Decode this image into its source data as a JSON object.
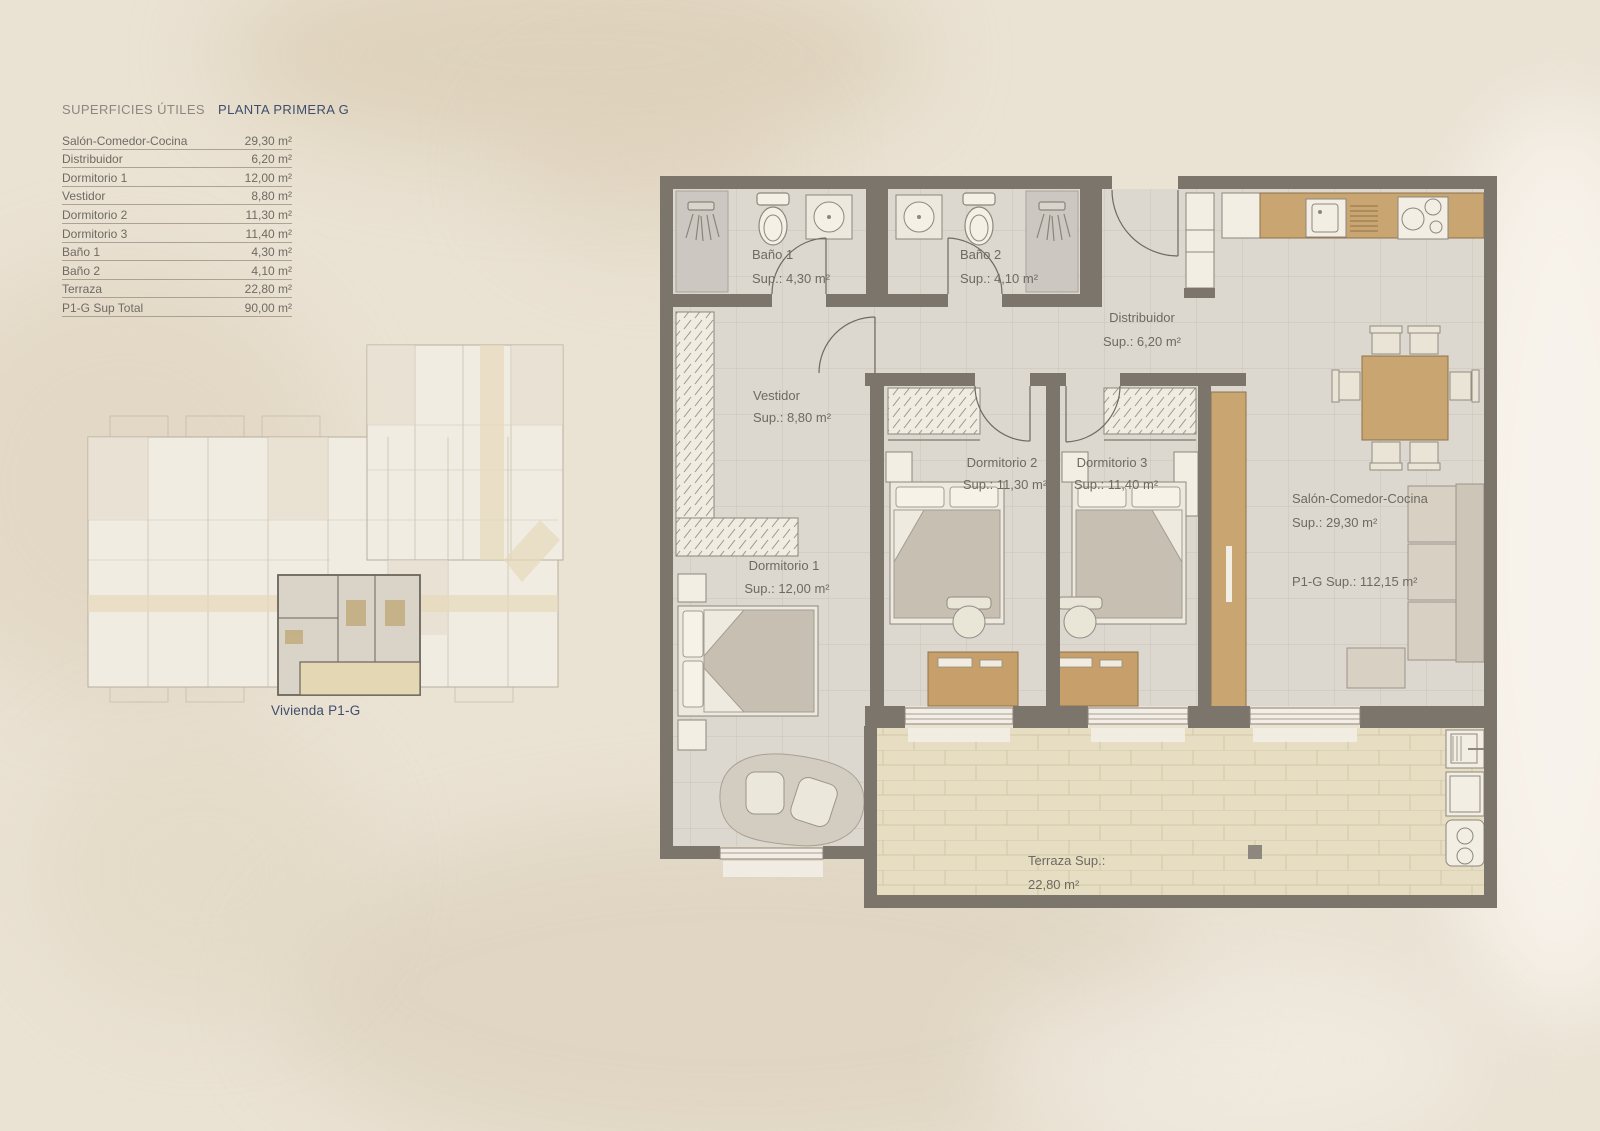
{
  "surface_table": {
    "title_left": "SUPERFICIES ÚTILES",
    "title_right": "PLANTA PRIMERA  G",
    "rows": [
      {
        "label": "Salón-Comedor-Cocina",
        "value": "29,30 m²"
      },
      {
        "label": "Distribuidor",
        "value": "6,20 m²"
      },
      {
        "label": "Dormitorio 1",
        "value": "12,00 m²"
      },
      {
        "label": "Vestidor",
        "value": "8,80 m²"
      },
      {
        "label": "Dormitorio 2",
        "value": "11,30 m²"
      },
      {
        "label": "Dormitorio 3",
        "value": "11,40 m²"
      },
      {
        "label": "Baño 1",
        "value": "4,30 m²"
      },
      {
        "label": "Baño 2",
        "value": "4,10 m²"
      },
      {
        "label": "Terraza",
        "value": "22,80 m²"
      },
      {
        "label": "P1-G Sup Total",
        "value": "90,00 m²"
      }
    ]
  },
  "overview": {
    "caption": "Vivienda P1-G"
  },
  "plan": {
    "rooms": {
      "bano1": {
        "name": "Baño 1",
        "sup": "Sup.: 4,30  m²"
      },
      "bano2": {
        "name": "Baño 2",
        "sup": "Sup.: 4,10 m²"
      },
      "distribuidor": {
        "name": "Distribuidor",
        "sup": "Sup.: 6,20 m²"
      },
      "vestidor": {
        "name": "Vestidor",
        "sup": "Sup.: 8,80 m²"
      },
      "dormitorio1": {
        "name": "Dormitorio 1",
        "sup": "Sup.: 12,00 m²"
      },
      "dormitorio2": {
        "name": "Dormitorio 2",
        "sup": "Sup.: 11,30 m²"
      },
      "dormitorio3": {
        "name": "Dormitorio 3",
        "sup": "Sup.: 11,40 m²"
      },
      "salon": {
        "name": "Salón-Comedor-Cocina",
        "sup": "Sup.: 29,30 m²",
        "total": "P1-G Sup.: 112,15 m²"
      },
      "terraza": {
        "name": "Terraza Sup.:",
        "sup": "22,80 m²"
      }
    },
    "colors": {
      "wall": "#7b756c",
      "floor": "#dcd7cf",
      "terrace": "#e6ddc2",
      "wood": "#c9a572",
      "accent_navy": "#3f4e6e",
      "label_text": "#6e6a62"
    }
  }
}
